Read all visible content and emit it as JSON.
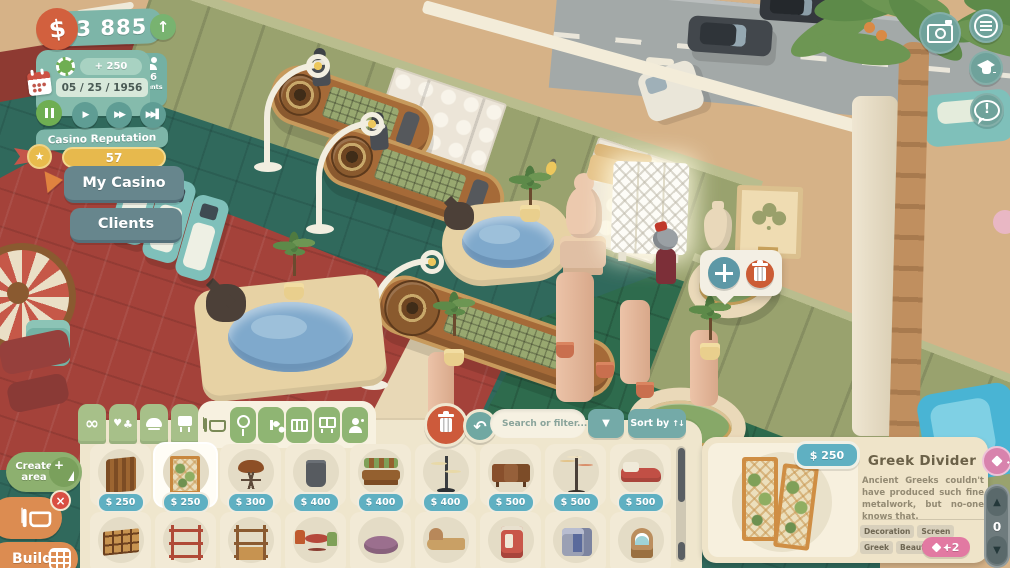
{
  "hud": {
    "money": "93 885",
    "income_per_tick": "+ 250",
    "date": "05 / 25 / 1956",
    "clients_count": "26",
    "clients_label": "Clients",
    "reputation_label": "Casino Reputation",
    "reputation_value": "57",
    "my_casino": "My Casino",
    "clients_btn": "Clients",
    "icons": [
      "dollar-coin",
      "trend-up",
      "poker-chip",
      "calendar",
      "pause",
      "play",
      "fast-forward",
      "skip",
      "clients-people",
      "reputation-coin"
    ]
  },
  "top_right_icons": [
    "camera",
    "menu",
    "graduation-cap",
    "feedback-bubble"
  ],
  "selection_popup": {
    "icons": [
      "move-arrows",
      "trash-can"
    ]
  },
  "build": {
    "category_tabs": [
      "infinity",
      "card-suits",
      "cloche",
      "sign"
    ],
    "subcategory_tabs": [
      "furniture",
      "pin",
      "plant",
      "folding-map",
      "screen",
      "staff"
    ],
    "tool_icons": [
      "trash-can",
      "undo"
    ],
    "search_placeholder": "Search or filter...",
    "sort_label": "Sort by",
    "items": [
      {
        "name": "wooden-divider",
        "price": "$ 250"
      },
      {
        "name": "greek-divider",
        "price": "$ 250",
        "selected": true
      },
      {
        "name": "plant-stand",
        "price": "$ 300"
      },
      {
        "name": "trash-can",
        "price": "$ 400"
      },
      {
        "name": "garden-bench",
        "price": "$ 400"
      },
      {
        "name": "floor-lamp",
        "price": "$ 400"
      },
      {
        "name": "sideboard",
        "price": "$ 500"
      },
      {
        "name": "coat-stand",
        "price": "$ 500"
      },
      {
        "name": "daybed",
        "price": "$ 500"
      }
    ],
    "items_row2": [
      "cubby-shelf",
      "red-shelf",
      "wooden-shelf",
      "table-set",
      "pouf",
      "chaise",
      "vending-machine",
      "kiosk",
      "jukebox"
    ]
  },
  "details": {
    "price": "$ 250",
    "title": "Greek Divider",
    "description": "Ancient Greeks couldn't have produced such fine metalwork, but no-one knows that.",
    "tags": [
      "Decoration",
      "Screen",
      "Greek",
      "Beauty"
    ],
    "beauty_bonus": "+2"
  },
  "left_actions": {
    "create_area": "Create area",
    "build": "Build"
  },
  "right_stepper": {
    "value": "0"
  },
  "colors": {
    "hud_teal": "#7db5a8",
    "button_teal": "#6fa29b",
    "accent_orange": "#dc8c51",
    "accent_red": "#d94f43",
    "accent_green": "#8db06f",
    "price_badge": "#5fb0c2",
    "reputation_yellow": "#e7b94d",
    "bonus_pink": "#e279a2",
    "panel_cream": "#efe6cd"
  }
}
